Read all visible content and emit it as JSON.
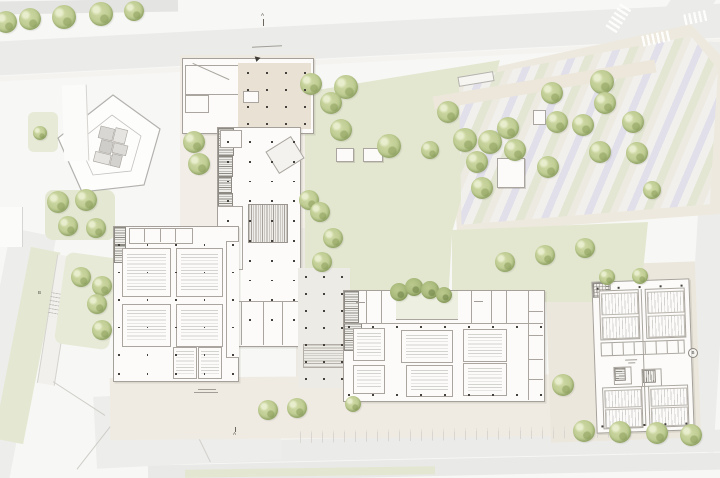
{
  "markers": {
    "a_top": "A",
    "a_bottom": "A",
    "b_right": "B",
    "b_left": "B"
  },
  "colors": {
    "road": "#ebebe9",
    "plaza": "#eee9de",
    "lawn": "#e3e7d0",
    "building_fill": "#fcfbf9",
    "building_line": "#a5a19a",
    "tree_green": "#b5c58c",
    "column_dot": "#45423d"
  },
  "parking": {
    "stripe_colors": [
      "#f1f0ed",
      "#e1dfe9",
      "#e3e6d2",
      "#edeae1"
    ]
  },
  "trees": [
    [
      6,
      22,
      11
    ],
    [
      30,
      19,
      11
    ],
    [
      64,
      17,
      12
    ],
    [
      101,
      14,
      12
    ],
    [
      134,
      11,
      10
    ],
    [
      194,
      142,
      11
    ],
    [
      199,
      164,
      11
    ],
    [
      40,
      133,
      7
    ],
    [
      58,
      202,
      11
    ],
    [
      86,
      200,
      11
    ],
    [
      68,
      226,
      10
    ],
    [
      96,
      228,
      10
    ],
    [
      81,
      277,
      10
    ],
    [
      102,
      286,
      10
    ],
    [
      97,
      304,
      10
    ],
    [
      102,
      330,
      10
    ],
    [
      309,
      200,
      10
    ],
    [
      311,
      84,
      11
    ],
    [
      346,
      87,
      12
    ],
    [
      331,
      103,
      11
    ],
    [
      341,
      130,
      11
    ],
    [
      389,
      146,
      12
    ],
    [
      320,
      212,
      10
    ],
    [
      333,
      238,
      10
    ],
    [
      322,
      262,
      10
    ],
    [
      448,
      112,
      11
    ],
    [
      430,
      150,
      9
    ],
    [
      465,
      140,
      12
    ],
    [
      490,
      142,
      12
    ],
    [
      508,
      128,
      11
    ],
    [
      515,
      150,
      11
    ],
    [
      477,
      162,
      11
    ],
    [
      552,
      93,
      11
    ],
    [
      557,
      122,
      11
    ],
    [
      583,
      125,
      11
    ],
    [
      602,
      82,
      12
    ],
    [
      605,
      103,
      11
    ],
    [
      633,
      122,
      11
    ],
    [
      637,
      153,
      11
    ],
    [
      600,
      152,
      11
    ],
    [
      548,
      167,
      11
    ],
    [
      482,
      188,
      11
    ],
    [
      505,
      262,
      10
    ],
    [
      545,
      255,
      10
    ],
    [
      585,
      248,
      10
    ],
    [
      652,
      190,
      9
    ],
    [
      607,
      277,
      8
    ],
    [
      640,
      276,
      8
    ],
    [
      399,
      292,
      9,
      "d"
    ],
    [
      414,
      287,
      9,
      "d"
    ],
    [
      430,
      290,
      9,
      "d"
    ],
    [
      444,
      295,
      8,
      "d"
    ],
    [
      268,
      410,
      10
    ],
    [
      297,
      408,
      10
    ],
    [
      353,
      404,
      8
    ],
    [
      563,
      385,
      11
    ],
    [
      584,
      431,
      11
    ],
    [
      620,
      432,
      11
    ],
    [
      657,
      433,
      11
    ],
    [
      691,
      435,
      11
    ]
  ],
  "dot_grids": [
    {
      "parent": "stage",
      "x": 247,
      "y": 72,
      "cols": 4,
      "rows": 4,
      "dx": 19,
      "dy": 17
    },
    {
      "parent": "bC",
      "x": 9,
      "y": 13,
      "cols": 4,
      "rows": 10,
      "dx": 22,
      "dy": 19.8
    },
    {
      "parent": "bL",
      "x": 4,
      "y": 17,
      "cols": 5,
      "rows": 5,
      "dx": 28.5,
      "dy": 27.5
    },
    {
      "parent": "bL",
      "x": 4,
      "y": 146,
      "cols": 5,
      "rows": 1,
      "dx": 28.5,
      "dy": 0
    },
    {
      "parent": "bB",
      "x": 4,
      "y": 35,
      "cols": 9,
      "rows": 1,
      "dx": 24,
      "dy": 0
    },
    {
      "parent": "bB",
      "x": 4,
      "y": 103,
      "cols": 9,
      "rows": 1,
      "dx": 24,
      "dy": 0
    },
    {
      "parent": "bR",
      "x": 4,
      "y": 5,
      "cols": 5,
      "rows": 1,
      "dx": 21,
      "dy": 0
    },
    {
      "parent": "bR",
      "x": 4,
      "y": 143,
      "cols": 5,
      "rows": 1,
      "dx": 21,
      "dy": 0
    },
    {
      "parent": "sp",
      "x": 7,
      "y": 8,
      "cols": 3,
      "rows": 7,
      "dx": 18,
      "dy": 17
    }
  ]
}
